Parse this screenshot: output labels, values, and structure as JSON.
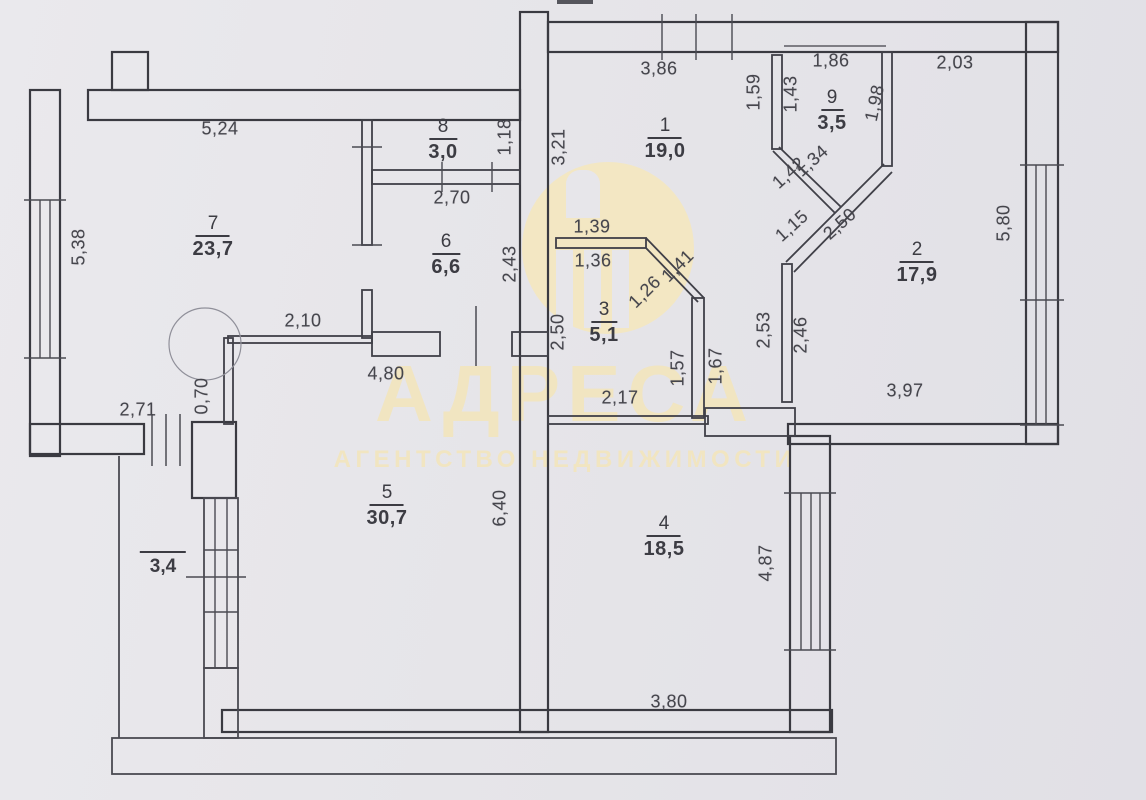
{
  "watermark": {
    "title": "АДРЕСА",
    "subtitle": "АГЕНТСТВО НЕДВИЖИМОСТИ",
    "logo": "building-columns-emblem",
    "color": "#f1e5c1"
  },
  "rooms": {
    "r1": {
      "number": "1",
      "area": "19,0"
    },
    "r2": {
      "number": "2",
      "area": "17,9"
    },
    "r3": {
      "number": "3",
      "area": "5,1"
    },
    "r4": {
      "number": "4",
      "area": "18,5"
    },
    "r5": {
      "number": "5",
      "area": "30,7"
    },
    "r6": {
      "number": "6",
      "area": "6,6"
    },
    "r7": {
      "number": "7",
      "area": "23,7"
    },
    "r8": {
      "number": "8",
      "area": "3,0"
    },
    "r9": {
      "number": "9",
      "area": "3,5"
    },
    "balcony": {
      "area": "3,4"
    }
  },
  "dimensions": {
    "d5_24": "5,24",
    "d5_38": "5,38",
    "d2_71": "2,71",
    "d0_70": "0,70",
    "d2_10": "2,10",
    "d4_80": "4,80",
    "d6_40": "6,40",
    "d1_18": "1,18",
    "d2_70": "2,70",
    "d2_43": "2,43",
    "d3_21": "3,21",
    "d3_86": "3,86",
    "d1_59": "1,59",
    "d1_43": "1,43",
    "d1_86": "1,86",
    "d1_98": "1,98",
    "d2_03": "2,03",
    "d1_42": "1,42",
    "d1_34": "1,34",
    "d1_15": "1,15",
    "d2_50_d": "2,50",
    "d5_80": "5,80",
    "d1_39": "1,39",
    "d1_36": "1,36",
    "d1_41": "1,41",
    "d1_26": "1,26",
    "d2_50_v": "2,50",
    "d1_57": "1,57",
    "d1_67": "1,67",
    "d2_17": "2,17",
    "d2_53": "2,53",
    "d2_46": "2,46",
    "d3_97": "3,97",
    "d4_87": "4,87",
    "d3_80": "3,80"
  }
}
